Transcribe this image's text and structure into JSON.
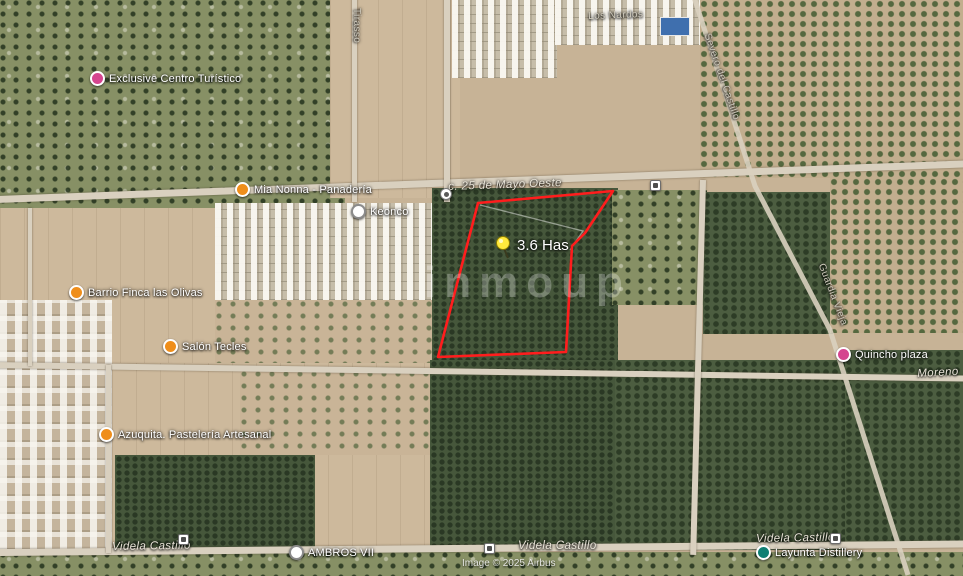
{
  "watermark": "inmoup",
  "attribution": "Image © 2025 Airbus",
  "parcel": {
    "area_label": "3.6 Has",
    "boundary_color": "#ff1d1d",
    "pin_color": "#ffe93d"
  },
  "pois": [
    {
      "label": "Exclusive Centro Turístico",
      "icon": "attraction-icon",
      "color": "#d5458f"
    },
    {
      "label": "Mia Nonna - Panadería",
      "icon": "bakery-icon",
      "color": "#ef8e1b"
    },
    {
      "label": "Keonco",
      "icon": "bus-stop-icon",
      "color": "#ffffff"
    },
    {
      "label": "Barrio Finca las Olivas",
      "icon": "neighborhood-icon",
      "color": "#ef8e1b"
    },
    {
      "label": "Salón Tecles",
      "icon": "venue-icon",
      "color": "#ef8e1b"
    },
    {
      "label": "Azuquita. Pastelería Artesanal",
      "icon": "bakery-icon",
      "color": "#ef8e1b"
    },
    {
      "label": "AMBROS VII",
      "icon": "bus-stop-icon",
      "color": "#ffffff"
    },
    {
      "label": "Quincho plaza",
      "icon": "attraction-icon",
      "color": "#d5458f"
    },
    {
      "label": "Layunta Distillery",
      "icon": "distillery-icon",
      "color": "#0f7f73"
    }
  ],
  "streets": [
    {
      "label": "c. 25 de Mayo Oeste"
    },
    {
      "label": "Los Nardos"
    },
    {
      "label": "Tirasso"
    },
    {
      "label": "Severo del Castillo"
    },
    {
      "label": "Guardia Vieja"
    },
    {
      "label": "Moreno"
    },
    {
      "label": "Videla Castillo"
    },
    {
      "label": "Videla Castillo"
    },
    {
      "label": "Videla Castillo"
    }
  ]
}
